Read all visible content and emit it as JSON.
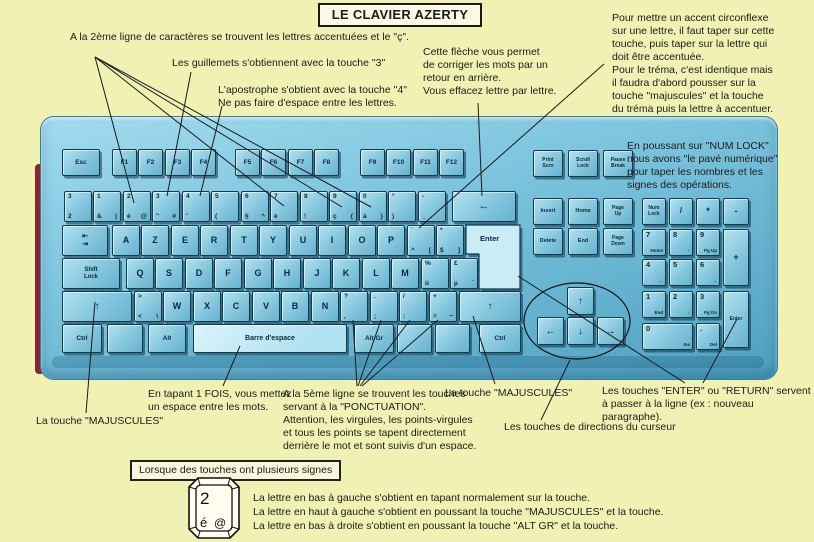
{
  "title": "LE CLAVIER AZERTY",
  "colors": {
    "background": "#f0f1b2",
    "keyboard_blue": "#6fb9d5",
    "key_blue": "#8ccadf",
    "highlight_key": "#c2e9f6",
    "line_black": "#1a1a1a"
  },
  "notes": {
    "accents": "A la 2ème ligne de caractères se trouvent les lettres accentuées et le \"ç\".",
    "guillemets": "Les guillemets s'obtiennent avec la touche \"3\"",
    "apostrophe": "L'apostrophe s'obtient avec la touche \"4\"\nNe pas faire d'espace entre les lettres.",
    "backspace": "Cette flèche vous permet\nde corriger les mots par un\nretour en arrière.\nVous effacez lettre par lettre.",
    "circonflexe": "Pour mettre un accent circonflexe\nsur une lettre, il faut taper sur cette\ntouche, puis taper sur la lettre qui\ndoit être accentuée.\nPour le tréma, c'est identique mais\nil faudra d'abord pousser sur la\ntouche \"majuscules\" et la touche\ndu tréma puis la lettre à accentuer.",
    "numlock": "En poussant sur \"NUM LOCK\"\nnous avons \"le pavé numérique\"\npour taper les nombres et les\nsignes des opérations.",
    "espace": "En tapant 1 FOIS, vous mettez\nun espace entre les mots.",
    "ponctuation": "A la 5ème ligne se trouvent les touches\nservant à la \"PONCTUATION\".\nAttention, les virgules, les points-virgules\net tous les points se tapent directement\nderrière le mot et sont suivis d'un espace.",
    "maj_left": "La touche \"MAJUSCULES\"",
    "maj_right": "La touche \"MAJUSCULES\"",
    "enter": "Les touches \"ENTER\" ou \"RETURN\" servent\nà passer à la ligne (ex : nouveau paragraphe).",
    "curseur": "Les touches de directions du curseur",
    "plusieurs": "Lorsque des touches ont plusieurs signes",
    "legende": "La lettre en bas à gauche s'obtient en tapant normalement sur la touche.\nLa lettre en haut à gauche s'obtient en poussant la touche \"MAJUSCULES\" et la touche.\nLa lettre en bas à droite s'obtient en poussant la touche \"ALT GR\" et la touche."
  },
  "sample_key": {
    "top": "2",
    "bottom_left": "é",
    "bottom_right": "@"
  },
  "keyboard": {
    "enter_label": "Enter",
    "rows": [
      {
        "y": 149,
        "h": 25,
        "w": 23,
        "keys": [
          {
            "x": 62,
            "w": 36,
            "c": "Esc",
            "cs": 6.5,
            "n": "esc"
          },
          {
            "x": 112,
            "c": "F1",
            "cs": 6.5
          },
          {
            "x": 138,
            "c": "F2",
            "cs": 6.5
          },
          {
            "x": 165,
            "c": "F3",
            "cs": 6.5
          },
          {
            "x": 191,
            "c": "F4",
            "cs": 6.5
          },
          {
            "x": 235,
            "c": "F5",
            "cs": 6.5
          },
          {
            "x": 261,
            "c": "F6",
            "cs": 6.5
          },
          {
            "x": 288,
            "c": "F7",
            "cs": 6.5
          },
          {
            "x": 314,
            "c": "F8",
            "cs": 6.5
          },
          {
            "x": 360,
            "c": "F9",
            "cs": 6.5
          },
          {
            "x": 386,
            "c": "F10",
            "cs": 6.5
          },
          {
            "x": 413,
            "c": "F11",
            "cs": 6.5
          },
          {
            "x": 439,
            "c": "F12",
            "cs": 6.5
          }
        ]
      },
      {
        "y": 191,
        "h": 29,
        "w": 26,
        "keys": [
          {
            "x": 64,
            "tl": "3",
            "bl": "2",
            "n": "sup23"
          },
          {
            "x": 93,
            "tl": "1",
            "bl": "&",
            "br": "|",
            "n": "1"
          },
          {
            "x": 123,
            "tl": "2",
            "bl": "é",
            "br": "@",
            "n": "2-e-acute"
          },
          {
            "x": 152,
            "tl": "3",
            "bl": "\"",
            "br": "#",
            "n": "3-guillemets"
          },
          {
            "x": 182,
            "tl": "4",
            "bl": "'",
            "n": "4-apostrophe"
          },
          {
            "x": 211,
            "tl": "5",
            "bl": "(",
            "n": "5"
          },
          {
            "x": 241,
            "tl": "6",
            "bl": "§",
            "br": "^",
            "n": "6"
          },
          {
            "x": 270,
            "tl": "7",
            "bl": "è",
            "n": "7-e-grave"
          },
          {
            "x": 300,
            "tl": "8",
            "bl": "!",
            "n": "8"
          },
          {
            "x": 329,
            "tl": "9",
            "bl": "ç",
            "br": "{",
            "n": "9-c-cedilla"
          },
          {
            "x": 359,
            "tl": "0",
            "bl": "à",
            "br": "}",
            "n": "0-a-grave"
          },
          {
            "x": 388,
            "tl": "°",
            "bl": ")",
            "n": "degre"
          },
          {
            "x": 418,
            "tl": "-",
            "bl": "_",
            "n": "tiret"
          },
          {
            "x": 452,
            "w": 62,
            "c": "←",
            "cs": 11,
            "n": "backspace"
          }
        ]
      },
      {
        "y": 225,
        "h": 29,
        "w": 26,
        "keys": [
          {
            "x": 62,
            "w": 44,
            "c": "⇤\n⇥",
            "cs": 7,
            "n": "tab"
          },
          {
            "x": 112,
            "c": "A"
          },
          {
            "x": 141,
            "c": "Z"
          },
          {
            "x": 171,
            "c": "E"
          },
          {
            "x": 200,
            "c": "R"
          },
          {
            "x": 230,
            "c": "T"
          },
          {
            "x": 259,
            "c": "Y"
          },
          {
            "x": 289,
            "c": "U"
          },
          {
            "x": 318,
            "c": "I"
          },
          {
            "x": 348,
            "c": "O"
          },
          {
            "x": 377,
            "c": "P"
          },
          {
            "x": 407,
            "tl": "¨",
            "bl": "^",
            "br": "[",
            "n": "trema-circonflexe"
          },
          {
            "x": 436,
            "tl": "*",
            "bl": "$",
            "br": "]",
            "n": "dollar"
          }
        ]
      },
      {
        "y": 258,
        "h": 29,
        "w": 26,
        "keys": [
          {
            "x": 62,
            "w": 56,
            "c": "Shift\nLock",
            "cs": 6,
            "n": "shift-lock"
          },
          {
            "x": 126,
            "c": "Q"
          },
          {
            "x": 155,
            "c": "S"
          },
          {
            "x": 185,
            "c": "D"
          },
          {
            "x": 214,
            "c": "F"
          },
          {
            "x": 244,
            "c": "G"
          },
          {
            "x": 273,
            "c": "H"
          },
          {
            "x": 303,
            "c": "J"
          },
          {
            "x": 332,
            "c": "K"
          },
          {
            "x": 362,
            "c": "L"
          },
          {
            "x": 391,
            "c": "M"
          },
          {
            "x": 421,
            "tl": "%",
            "bl": "ù",
            "n": "u-grave"
          },
          {
            "x": 450,
            "tl": "£",
            "bl": "µ",
            "br": "`",
            "n": "livre-mu"
          }
        ]
      },
      {
        "y": 291,
        "h": 29,
        "w": 26,
        "keys": [
          {
            "x": 62,
            "w": 68,
            "c": "↑",
            "cs": 10,
            "n": "shift-left"
          },
          {
            "x": 134,
            "tl": ">",
            "bl": "<",
            "br": "\\",
            "n": "chevrons"
          },
          {
            "x": 163,
            "c": "W"
          },
          {
            "x": 193,
            "c": "X"
          },
          {
            "x": 222,
            "c": "C"
          },
          {
            "x": 252,
            "c": "V"
          },
          {
            "x": 281,
            "c": "B"
          },
          {
            "x": 311,
            "c": "N"
          },
          {
            "x": 340,
            "tl": "?",
            "bl": ",",
            "n": "virgule"
          },
          {
            "x": 370,
            "tl": ".",
            "bl": ";",
            "n": "point-virgule"
          },
          {
            "x": 399,
            "tl": "/",
            "bl": ":",
            "n": "deux-points"
          },
          {
            "x": 429,
            "tl": "+",
            "bl": "=",
            "br": "~",
            "n": "egal"
          },
          {
            "x": 459,
            "w": 60,
            "c": "↑",
            "cs": 10,
            "n": "shift-right"
          }
        ]
      },
      {
        "y": 324,
        "h": 27,
        "w": 38,
        "keys": [
          {
            "x": 62,
            "c": "Ctrl",
            "cs": 6.5,
            "n": "ctrl-left"
          },
          {
            "x": 107,
            "w": 34,
            "c": "",
            "n": "blank-1"
          },
          {
            "x": 148,
            "w": 36,
            "c": "Alt",
            "cs": 6.5,
            "n": "alt"
          },
          {
            "x": 193,
            "w": 152,
            "c": "Barre d'espace",
            "cs": 7,
            "hl": true,
            "n": "space"
          },
          {
            "x": 354,
            "c": "Alt Gr",
            "cs": 6.5,
            "n": "alt-gr"
          },
          {
            "x": 397,
            "w": 33,
            "c": "",
            "n": "blank-2"
          },
          {
            "x": 435,
            "w": 33,
            "c": "",
            "n": "blank-3"
          },
          {
            "x": 479,
            "w": 40,
            "c": "Ctrl",
            "cs": 6.5,
            "n": "ctrl-right"
          }
        ]
      },
      {
        "y": 150,
        "h": 25,
        "w": 28,
        "keys": [
          {
            "x": 533,
            "c": "Print\nScrn",
            "cs": 5,
            "n": "print-screen"
          },
          {
            "x": 568,
            "c": "Scroll\nLock",
            "cs": 5,
            "n": "scroll-lock"
          },
          {
            "x": 603,
            "c": "Pause\nBreak",
            "cs": 5,
            "n": "pause-break"
          }
        ]
      },
      {
        "y": 198,
        "h": 25,
        "w": 28,
        "keys": [
          {
            "x": 533,
            "c": "Insert",
            "cs": 5.5,
            "n": "insert"
          },
          {
            "x": 568,
            "c": "Home",
            "cs": 5.5,
            "n": "home"
          },
          {
            "x": 603,
            "c": "Page\nUp",
            "cs": 5,
            "n": "page-up"
          }
        ]
      },
      {
        "y": 228,
        "h": 25,
        "w": 28,
        "keys": [
          {
            "x": 533,
            "c": "Delete",
            "cs": 5.5,
            "n": "delete"
          },
          {
            "x": 568,
            "c": "End",
            "cs": 5.5,
            "n": "end"
          },
          {
            "x": 603,
            "c": "Page\nDown",
            "cs": 5,
            "n": "page-down"
          }
        ]
      },
      {
        "y": 287,
        "h": 26,
        "w": 25,
        "keys": [
          {
            "x": 567,
            "c": "↑",
            "cs": 10,
            "n": "arrow-up"
          }
        ]
      },
      {
        "y": 317,
        "h": 26,
        "w": 25,
        "keys": [
          {
            "x": 537,
            "c": "←",
            "cs": 10,
            "n": "arrow-left"
          },
          {
            "x": 567,
            "c": "↓",
            "cs": 10,
            "n": "arrow-down"
          },
          {
            "x": 597,
            "c": "→",
            "cs": 10,
            "n": "arrow-right"
          }
        ]
      },
      {
        "y": 198,
        "h": 25,
        "w": 22,
        "keys": [
          {
            "x": 642,
            "c": "Num\nLock",
            "cs": 5,
            "n": "num-lock"
          },
          {
            "x": 669,
            "c": "/",
            "cs": 8,
            "n": "numpad-divide"
          },
          {
            "x": 696,
            "c": "*",
            "cs": 9,
            "n": "numpad-multiply"
          },
          {
            "x": 723,
            "w": 24,
            "c": "-",
            "cs": 9,
            "n": "numpad-minus"
          }
        ]
      },
      {
        "y": 229,
        "h": 25,
        "w": 22,
        "keys": [
          {
            "x": 642,
            "np": 1,
            "tl": "7",
            "bl": "Home",
            "n": "numpad-7"
          },
          {
            "x": 669,
            "np": 1,
            "tl": "8",
            "bl": "↑",
            "n": "numpad-8"
          },
          {
            "x": 696,
            "np": 1,
            "tl": "9",
            "bl": "Pg Up",
            "n": "numpad-9"
          },
          {
            "x": 723,
            "w": 24,
            "h": 55,
            "c": "+",
            "cs": 9,
            "n": "numpad-plus"
          }
        ]
      },
      {
        "y": 259,
        "h": 25,
        "w": 22,
        "keys": [
          {
            "x": 642,
            "np": 1,
            "tl": "4",
            "bl": "←",
            "n": "numpad-4"
          },
          {
            "x": 669,
            "np": 1,
            "tl": "5",
            "n": "numpad-5"
          },
          {
            "x": 696,
            "np": 1,
            "tl": "6",
            "bl": "→",
            "n": "numpad-6"
          }
        ]
      },
      {
        "y": 291,
        "h": 25,
        "w": 22,
        "keys": [
          {
            "x": 642,
            "np": 1,
            "tl": "1",
            "bl": "End",
            "n": "numpad-1"
          },
          {
            "x": 669,
            "np": 1,
            "tl": "2",
            "bl": "↓",
            "n": "numpad-2"
          },
          {
            "x": 696,
            "np": 1,
            "tl": "3",
            "bl": "Pg Dn",
            "n": "numpad-3"
          },
          {
            "x": 723,
            "w": 24,
            "h": 55,
            "c": "Enter",
            "cs": 5,
            "n": "numpad-enter"
          }
        ]
      },
      {
        "y": 323,
        "h": 25,
        "w": 22,
        "keys": [
          {
            "x": 642,
            "w": 49,
            "np": 1,
            "tl": "0",
            "bl": "Ins",
            "n": "numpad-0"
          },
          {
            "x": 696,
            "np": 1,
            "tl": ".",
            "bl": "Del",
            "n": "numpad-dot"
          }
        ]
      }
    ]
  }
}
